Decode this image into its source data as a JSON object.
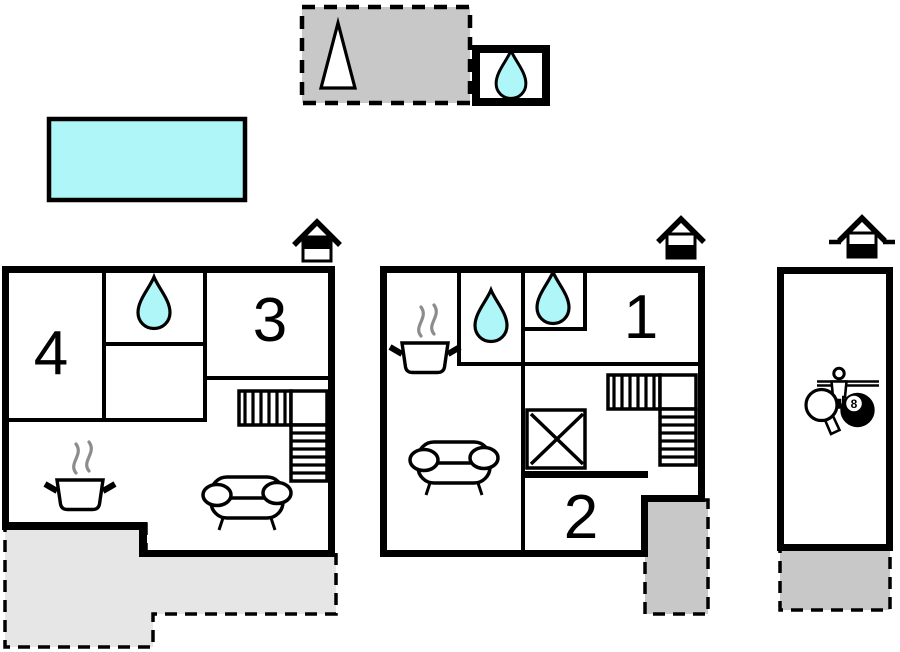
{
  "canvas": {
    "width": 900,
    "height": 652,
    "background": "#FFFFFF"
  },
  "colors": {
    "wall": "#000000",
    "water": "#AFF6F8",
    "gray_medium": "#C8C8C8",
    "gray_light": "#E6E6E6",
    "steam": "#8C8C8C",
    "white": "#FFFFFF"
  },
  "outdoor": {
    "garden_plot": {
      "icon": "tree-icon"
    },
    "outbuilding_bathroom": {
      "icon": "water-drop-icon"
    },
    "pool": {
      "icon": "swimming-pool"
    }
  },
  "upper_floor": {
    "floor_icon": "house-upper-floor-icon",
    "room_numbers": {
      "bedroom_a": "4",
      "bedroom_b": "3"
    },
    "features": [
      "water-drop-icon",
      "stove-icon",
      "sofa-icon",
      "stairs-icon"
    ],
    "terrace": {
      "style": "light"
    }
  },
  "ground_floor": {
    "floor_icon": "house-ground-floor-icon",
    "room_numbers": {
      "bedroom_a": "1",
      "bedroom_b": "2"
    },
    "features": [
      "water-drop-icon",
      "water-drop-icon",
      "stove-icon",
      "sofa-icon",
      "stairs-icon",
      "utility-icon"
    ],
    "terrace": {
      "style": "dark"
    }
  },
  "annex": {
    "floor_icon": "annex-ground-floor-icon",
    "features": [
      "foosball-icon",
      "table-tennis-icon",
      "billiard-ball-icon"
    ],
    "billiard_ball_number": "8",
    "terrace": {
      "style": "dark"
    }
  }
}
